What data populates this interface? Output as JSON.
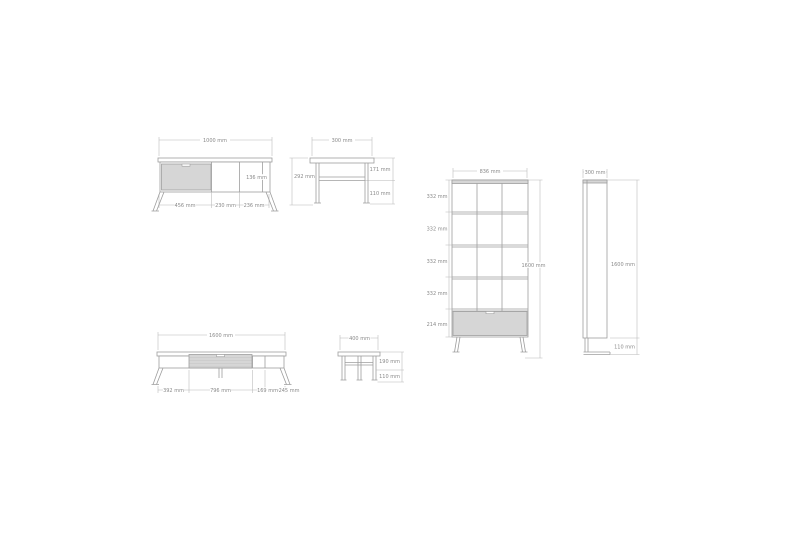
{
  "drawing": {
    "type": "furniture-dimension-drawing",
    "background": "#ffffff",
    "line_color": "#9e9e9e",
    "dimension_line_color": "#b7b7b7",
    "drawer_fill_color": "#d6d6d6",
    "label_color": "#8a8a8a",
    "views": {
      "tv1000_front": {
        "width": "1000 mm",
        "inner_height": "136 mm",
        "seg_a": "456 mm",
        "seg_b": "230 mm",
        "seg_c": "236 mm"
      },
      "tv300_side": {
        "depth": "300 mm",
        "height": "292 mm",
        "upper": "171 mm",
        "leg": "110 mm"
      },
      "shelf_front": {
        "width": "836 mm",
        "row1": "332 mm",
        "row2": "332 mm",
        "row3": "332 mm",
        "row4": "332 mm",
        "drawer_row": "214 mm",
        "height": "1600 mm"
      },
      "shelf_side": {
        "depth": "300 mm",
        "height": "1600 mm",
        "leg": "110 mm"
      },
      "tv1600_front": {
        "width": "1600 mm",
        "seg_a": "392 mm",
        "seg_b": "796 mm",
        "seg_c": "169 mm",
        "seg_d": "245 mm"
      },
      "tv400_side": {
        "depth": "400 mm",
        "upper": "190 mm",
        "leg": "110 mm"
      }
    }
  }
}
